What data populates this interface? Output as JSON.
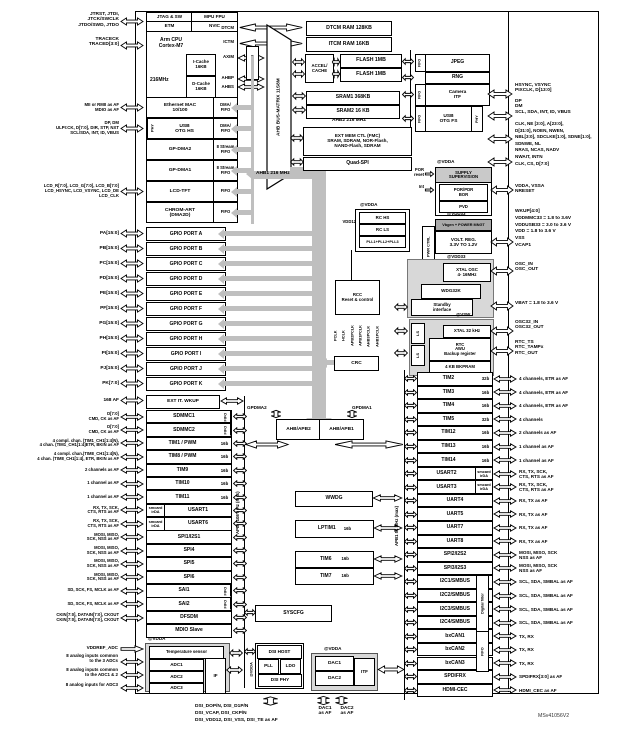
{
  "watermark": "MSv41056V2",
  "cpu": {
    "r1a": "JTAG & SW",
    "r1b": "MPU FPU",
    "r2a": "ETM",
    "r2b": "NVIC",
    "core": "Arm CPU\nCortex-M7",
    "freq": "216MHz",
    "icache": "I-Cache\n16KB",
    "dcache": "D-Cache\n16KB",
    "p_dtcm": "DTCM",
    "p_ictm": "ICTM",
    "p_axim": "AXIM",
    "p_ahbp": "AHBP",
    "p_ahbs": "AHBS",
    "jtag_pins": "JTRST, JTDI,\nJTCK/SWCLK\nJTDO/SWD, JTDO",
    "trace_pins": "TRACECK\nTRACED[3:0]"
  },
  "mem": {
    "dtcm": "DTCM RAM 128KB",
    "itcm": "ITCM RAM 16KB",
    "accel": "ACCEL/\nCACHE",
    "flash1": "FLASH 1MB",
    "flash2": "FLASH 1MB",
    "sram1": "SRAM1 368KB",
    "sram2": "SRAM2 16 KB",
    "fmc": "EXT MEM CTL (FMC)\nSRAM, SDRAM, NOR-Flash,\nNAND-Flash, SDRAM",
    "qspi": "Quad-SPI",
    "fmc_pins": "CLK, NE [3:0], A[23:0],\nD[31:0], NOEN, NWEN,\nNBL[3:0], SDCLKE[1:0], SDNE[1:0],\nSDNWE, NL\nNRAS, NCAS, NADV\nNWAIT, INTN",
    "qspi_pins": "CLK, CS, D[7:0]"
  },
  "ahbp": {
    "jpeg": "JPEG",
    "rng": "RNG",
    "cam": "Camera\nITF",
    "usb": "USB\nOTG FS",
    "phy": "PHY",
    "fifo": "FIFO",
    "cam_pins": "HSYNC, VSYNC\nPIXCLK, D[13:0]",
    "usb_pins": "DP\nDM\nSCL, SDA, INT, ID, VBUS"
  },
  "power": {
    "vdda": "@VDDA",
    "supply": "SUPPLY\nSUPERVISION",
    "porpdr": "POR/PDR\nBOR",
    "pvd": "PVD",
    "por": "POR\nreset",
    "int": "Int",
    "vdda_pins": "VDDA, VSSA\nNRESET",
    "volt_pins": "WKUP[4:0]\nVDDMMC33 = 1.8 to 3.6V\nVDDUSB33 = 3.0 to 3.6 V\nVDD = 1.8 to 3.6 V\nVSS\nVCAP1",
    "rchs": "RC HS",
    "rcls": "RC LS",
    "pll": "PLL1+PLL2+PLL3",
    "vdd12": "VDD12",
    "pm": "Vbgen + POWER MNGT",
    "vdd33": "@VDD33",
    "pwrctrl": "PWR CTRL",
    "vreg": "VOLT. REG.\n3.3V TO 1.2V",
    "xtal": "XTAL OSC\n4- 16MHz",
    "osc_pins": "OSC_IN\nOSC_OUT",
    "wdg": "WDG32K",
    "stby": "Standby\ninterface",
    "vbat": "VBAT = 1.8 to 3.6 V"
  },
  "backup": {
    "vsw": "@VSW",
    "ls": "LS",
    "xtal32": "XTAL 32 kHz",
    "rtc": "RTC\nAWU\nBackup register",
    "bkpram": "4 KB BKPRAM",
    "osc32_pins": "OSC32_IN\nOSC32_OUT",
    "rtc_pins": "RTC_TS\nRTC_TAMPx\nRTC_OUT"
  },
  "center": {
    "rcc": "RCC\nReset & control",
    "crc": "CRC",
    "gpdma2": "GPDMA2",
    "gpdma1": "GPDMA1",
    "b2": "AHB/APB2",
    "b1": "AHB/APB1",
    "wwdg": "WWDG",
    "lptim1": "LPTIM1",
    "tim6": "TIM6",
    "tim7": "TIM7",
    "b16": "16b",
    "syscfg": "SYSCFG"
  },
  "dsi": {
    "host": "DSI HOST",
    "pll": "PLL",
    "ldo": "LDO",
    "phy": "DSI PHY",
    "vdda": "@VDDA",
    "pins": "DSI_DOP/N, DSI_D1P/N\nDSI_VCAP, DSI_CKP/N\nDSI_VDD12, DSI_VSS, DSI_TE as AF"
  },
  "dac": {
    "vdda": "@VDDA",
    "d1": "DAC1",
    "d2": "DAC2",
    "itf": "ITF",
    "p1": "DAC1\nas AF",
    "p2": "DAC2\nas AF"
  },
  "adc": {
    "vdda": "@VDDA",
    "temp": "Temperature sensor",
    "a1": "ADC1",
    "a2": "ADC2",
    "a3": "ADC3",
    "if": "IF",
    "vddref": "VDDREF_ADC",
    "in1": "8 analog inputs common\nto the 3 ADCs",
    "in2": "8 analog inputs common\nto the ADC1 & 2",
    "in3": "8 analog inputs for ADC3"
  },
  "extit": {
    "label": "168 AF",
    "name": "EXT IT. WKUP"
  },
  "buses": {
    "matrix": "AHB BUS-MATRIX 11S8M",
    "ahb2axi": "AHB2AXI",
    "ahb1": "AHB1 216 MHz",
    "ahb2": "AHB2 216 MHZ",
    "apb1": "APB1 54 MHz (max)",
    "apb2": "APB2 108 MHz (max)",
    "filter": "Digital filter",
    "fifo": "FIFO",
    "clock_outs": [
      "PCLK",
      "HCLK",
      "APB2PCLK",
      "APB1PCLK",
      "AHB3PCLK",
      "AHB1PCLK"
    ]
  },
  "dma_rows": [
    {
      "label": "MII or RMII as AF\nMDIO as AF",
      "pin": true,
      "name": "Ethernet MAC\n10/100",
      "sub": "DMA/\nFIFO"
    },
    {
      "label": "DP, DM\nULPI:CK, D[7:0], DIR, STP, NXT\nSCL/SDA, INT, ID, VBUS",
      "pin": true,
      "prev": "PHY",
      "name": "USB\nOTG HS",
      "sub": "DMA/\nFIFO"
    },
    {
      "label": "",
      "pin": false,
      "name": "GP-DMA2",
      "sub": "8 Stream\nFIFO"
    },
    {
      "label": "",
      "pin": false,
      "name": "GP-DMA1",
      "sub": "8 Stream\nFIFO"
    },
    {
      "label": "LCD_R[7:0], LCD_G[7:0], LCD_B[7:0]\nLCD_HSYNC, LCD_VSYNC, LCD_DE\nLCD_CLK",
      "pin": true,
      "name": "LCD-TFT",
      "sub": "FIFO"
    },
    {
      "label": "",
      "pin": false,
      "name": "CHROM-ART\n(DMA2D)",
      "sub": "FIFO"
    }
  ],
  "gpio_rows": [
    {
      "pin": "PA[15:0]",
      "name": "GPIO PORT A"
    },
    {
      "pin": "PB[15:0]",
      "name": "GPIO PORT B"
    },
    {
      "pin": "PC[15:0]",
      "name": "GPIO PORT C"
    },
    {
      "pin": "PD[15:0]",
      "name": "GPIO PORT D"
    },
    {
      "pin": "PE[15:0]",
      "name": "GPIO PORT E"
    },
    {
      "pin": "PF[15:0]",
      "name": "GPIO PORT F"
    },
    {
      "pin": "PG[15:0]",
      "name": "GPIO PORT G"
    },
    {
      "pin": "PH[15:0]",
      "name": "GPIO PORT H"
    },
    {
      "pin": "PI[15:0]",
      "name": "GPIO PORT I"
    },
    {
      "pin": "PJ[15:0]",
      "name": "GPIO PORT J"
    },
    {
      "pin": "PK[7:0]",
      "name": "GPIO PORT K"
    }
  ],
  "apb2_rows": [
    {
      "label": "D[7:0]\nCMD, CK as AF",
      "pin": true,
      "name": "SDMMC1",
      "tag": "FIFO",
      "tagcls": "v"
    },
    {
      "label": "D[7:0]\nCMD, CK as AF",
      "pin": true,
      "name": "SDMMC2",
      "tag": "FIFO",
      "tagcls": "v"
    },
    {
      "label": "4 compl. chan. (TIM1_CH1[1:4]N),\n4 chan. (TIM1_CH1[1:4]ETR, BKIN as AF",
      "pin": true,
      "name": "TIM1 / PWM",
      "tag": "16b"
    },
    {
      "label": "4 compl. chan.(TIM8_CH1[1:4]N),\n4 chan. (TIM8_CH1[1:4], ETR, BKIN as AF",
      "pin": true,
      "name": "TIM8 / PWM",
      "tag": "16b"
    },
    {
      "label": "2 channels as AF",
      "pin": true,
      "name": "TIM9",
      "tag": "16b"
    },
    {
      "label": "1 channel as AF",
      "pin": true,
      "name": "TIM10",
      "tag": "16b"
    },
    {
      "label": "1 channel as AF",
      "pin": true,
      "name": "TIM11",
      "tag": "16b"
    },
    {
      "label": "RX, TX, SCK,\nCTS, RTS as AF",
      "pin": true,
      "pre": "smcard\nirDA",
      "name": "USART1"
    },
    {
      "label": "RX, TX, SCK,\nCTS, RTS as AF",
      "pin": true,
      "pre": "smcard\nirDA",
      "name": "USART6"
    },
    {
      "label": "MOSI, MISO,\nSCK, NSS as AF",
      "pin": true,
      "name": "SPI1/I2S1"
    },
    {
      "label": "MOSI, MISO,\nSCK, NSS as AF",
      "pin": true,
      "name": "SPI4"
    },
    {
      "label": "MOSI, MISO,\nSCK, NSS as AF",
      "pin": true,
      "name": "SPI5"
    },
    {
      "label": "MOSI, MISO,\nSCK, NSS as AF",
      "pin": true,
      "name": "SPI6"
    },
    {
      "label": "SD, SCK, FS, MCLK as AF",
      "pin": true,
      "name": "SAI1",
      "tag": "FIFO",
      "tagcls": "v"
    },
    {
      "label": "SD, SCK, FS, MCLK as AF",
      "pin": true,
      "name": "SAI2",
      "tag": "FIFO",
      "tagcls": "v"
    },
    {
      "label": "CKIN[7:0], DATAIN[7:0], CKOUT\nCKIN[7:0], DATAIN[7:0], CKOUT",
      "pin": true,
      "name": "DFSDM"
    },
    {
      "label": "",
      "pin": false,
      "name": "MDIO Slave"
    }
  ],
  "apb1_rows": [
    {
      "name": "TIM2",
      "tag": "32b",
      "label": "4 channels, ETR as AF"
    },
    {
      "name": "TIM3",
      "tag": "16b",
      "label": "4 channels, ETR as AF"
    },
    {
      "name": "TIM4",
      "tag": "16b",
      "label": "4 channels, ETR as AF"
    },
    {
      "name": "TIM5",
      "tag": "32b",
      "label": "4 channels"
    },
    {
      "name": "TIM12",
      "tag": "16b",
      "label": "2 channels as AF"
    },
    {
      "name": "TIM13",
      "tag": "16b",
      "label": "1 channel as AF"
    },
    {
      "name": "TIM14",
      "tag": "16b",
      "label": "1 channel as AF"
    },
    {
      "name": "USART2",
      "tag2": "smcard\nirDA",
      "label": "RX, TX, SCK,\nCTS, RTS as AF"
    },
    {
      "name": "USART3",
      "tag2": "smcard\nirDA",
      "label": "RX, TX, SCK,\nCTS, RTS as AF"
    },
    {
      "name": "UART4",
      "label": "RX, TX as AF"
    },
    {
      "name": "UART5",
      "label": "RX, TX as AF"
    },
    {
      "name": "UART7",
      "label": "RX, TX as AF"
    },
    {
      "name": "UART8",
      "label": "RX, TX as AF"
    },
    {
      "name": "SPI2/I2S2",
      "label": "MOSI, MISO, SCK\nNSS as AF"
    },
    {
      "name": "SPI3/I2S3",
      "label": "MOSI, MISO, SCK\nNSS as AF"
    },
    {
      "name": "I2C1/SMBUS",
      "label": "SCL, SDA, SMBAL as AF"
    },
    {
      "name": "I2C2/SMBUS",
      "label": "SCL, SDA, SMBAL as AF"
    },
    {
      "name": "I2C3/SMBUS",
      "label": "SCL, SDA, SMBAL as AF"
    },
    {
      "name": "I2C4/SMBUS",
      "label": "SCL, SDA, SMBAL as AF"
    },
    {
      "name": "bxCAN1",
      "label": "TX, RX"
    },
    {
      "name": "bxCAN2",
      "label": "TX, RX"
    },
    {
      "name": "bxCAN3",
      "label": "TX, RX"
    },
    {
      "name": "SPDIFRX",
      "label": "SPDIFRX[3:0] as AF"
    },
    {
      "name": "HDMI-CEC",
      "label": "HDMI_CEC as AF"
    }
  ]
}
